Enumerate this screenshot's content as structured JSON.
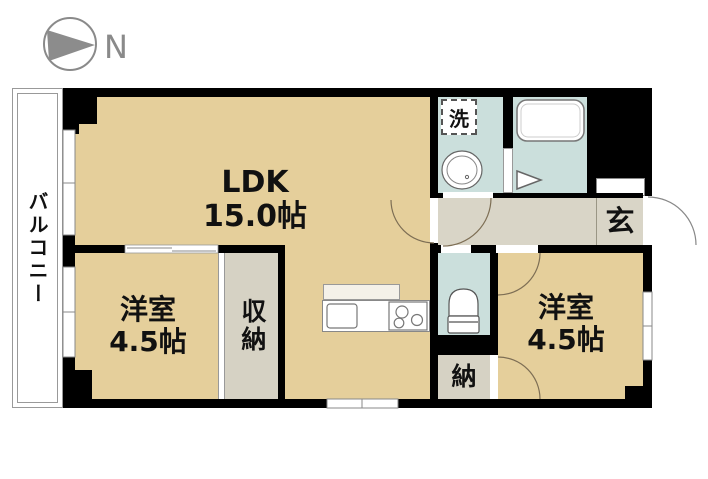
{
  "compass": {
    "label": "N"
  },
  "balcony": {
    "label": "バルコニー"
  },
  "rooms": {
    "ldk": {
      "label": "LDK",
      "size": "15.0帖"
    },
    "western_left": {
      "label": "洋室",
      "size": "4.5帖"
    },
    "western_right": {
      "label": "洋室",
      "size": "4.5帖"
    },
    "closet": {
      "label": "収納"
    },
    "storage": {
      "label": "納"
    },
    "entrance": {
      "label": "玄"
    },
    "laundry": {
      "label": "洗"
    }
  },
  "colors": {
    "wall": "#000000",
    "room_floor": "#E5CF9B",
    "wet_area_floor": "#CBDFDC",
    "hall_floor": "#D9D5C7",
    "closet_floor": "#D6D2C4",
    "door_arc": "#7D6E54",
    "compass_gray": "#8A8A8A"
  }
}
